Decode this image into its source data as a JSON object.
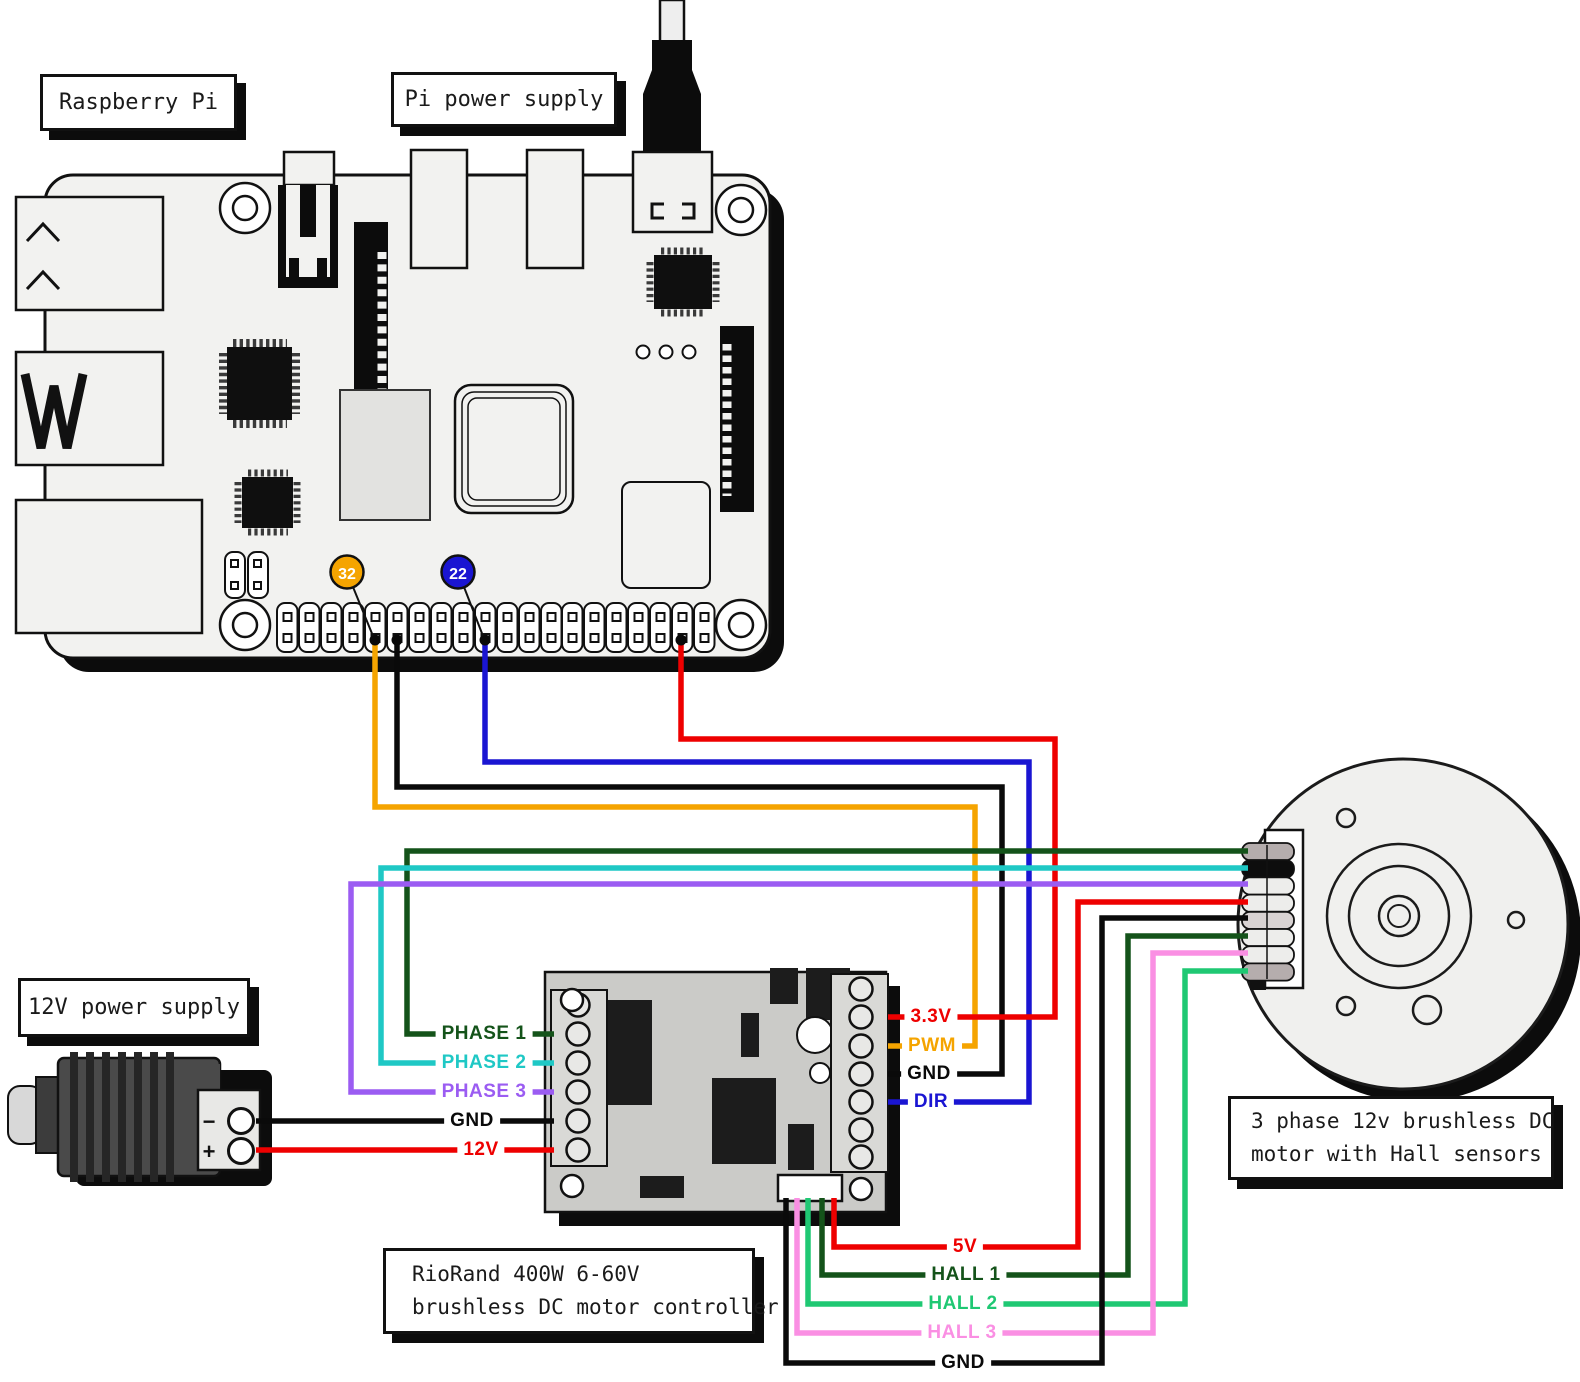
{
  "title_boxes": {
    "raspberry_pi": "Raspberry Pi",
    "pi_power_supply": "Pi power supply",
    "twelve_v_power_supply": "12V power supply"
  },
  "controller_label_lines": [
    "RioRand 400W 6-60V",
    "brushless DC motor controller"
  ],
  "motor_label_lines": [
    "3 phase 12v brushless DC",
    "motor with Hall sensors"
  ],
  "gpio_pin_badges": {
    "badge_32": "32",
    "badge_22": "22"
  },
  "power_supply_terminals": {
    "minus": "−",
    "plus": "+"
  },
  "wire_labels": {
    "phase1": "PHASE 1",
    "phase2": "PHASE 2",
    "phase3": "PHASE 3",
    "gnd_left": "GND",
    "v12": "12V",
    "v33": "3.3V",
    "pwm": "PWM",
    "gnd_right": "GND",
    "dir": "DIR",
    "v5": "5V",
    "hall1": "HALL 1",
    "hall2": "HALL 2",
    "hall3": "HALL 3",
    "gnd_bottom": "GND"
  },
  "colors": {
    "orange": "#F5A400",
    "blue": "#1A15D2",
    "red": "#EE0000",
    "black": "#0A0A0A",
    "dark_green": "#14531A",
    "cyan": "#1FC8C5",
    "purple": "#9B5CF2",
    "bright_green": "#1FC873",
    "pink": "#FA8FE3",
    "badge_text": "#FFFFFF"
  }
}
